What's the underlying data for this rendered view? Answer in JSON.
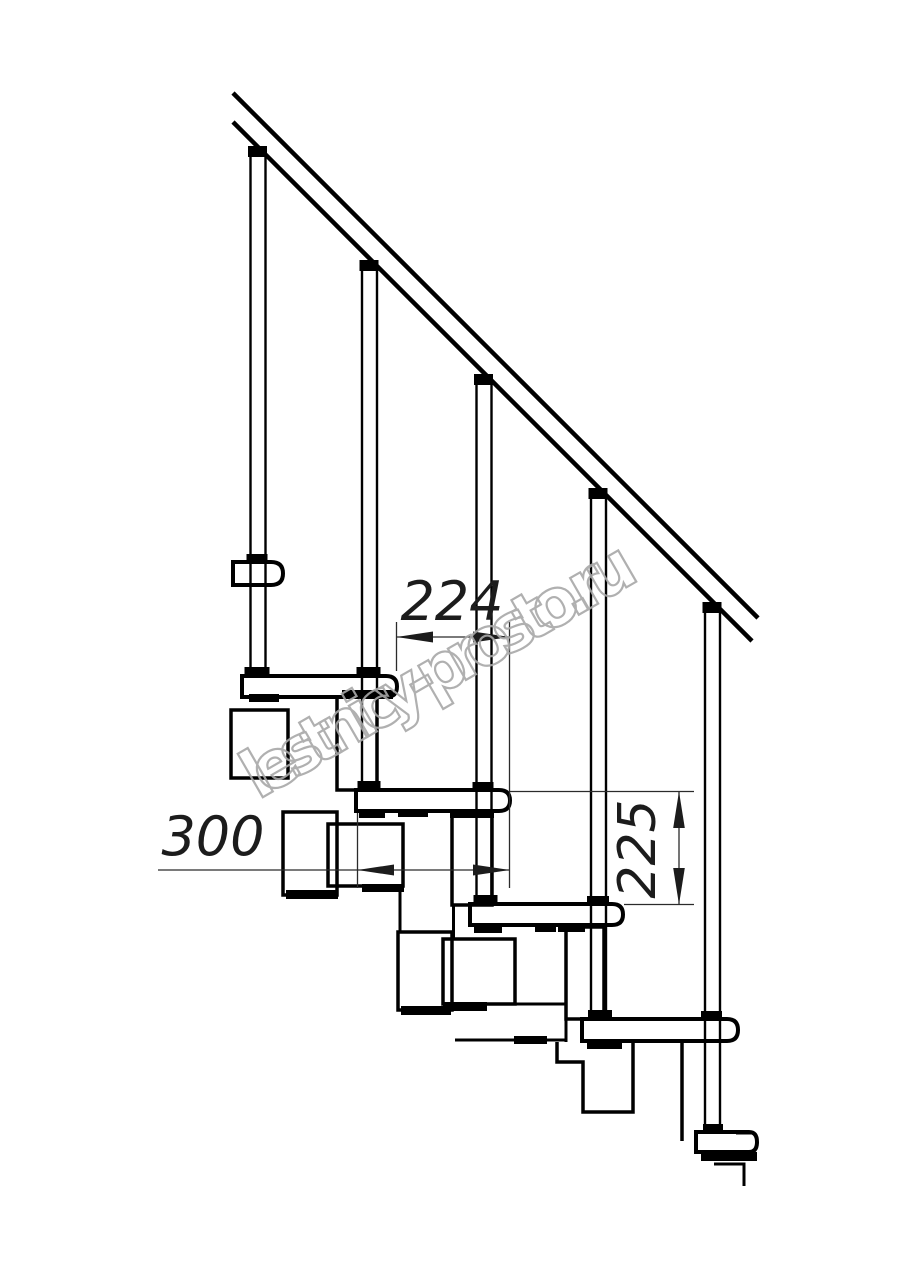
{
  "drawing": {
    "title": "Modular staircase side-view technical drawing",
    "watermark": "lestnicy-prosto.ru",
    "dimensions": {
      "run_mm": "224",
      "tread_depth_mm": "300",
      "riser_height_mm": "225"
    },
    "colors": {
      "background": "#ffffff",
      "outline": "#000000",
      "dimension_lines": "#2b2b2b",
      "watermark": "#a8a8a8"
    }
  }
}
